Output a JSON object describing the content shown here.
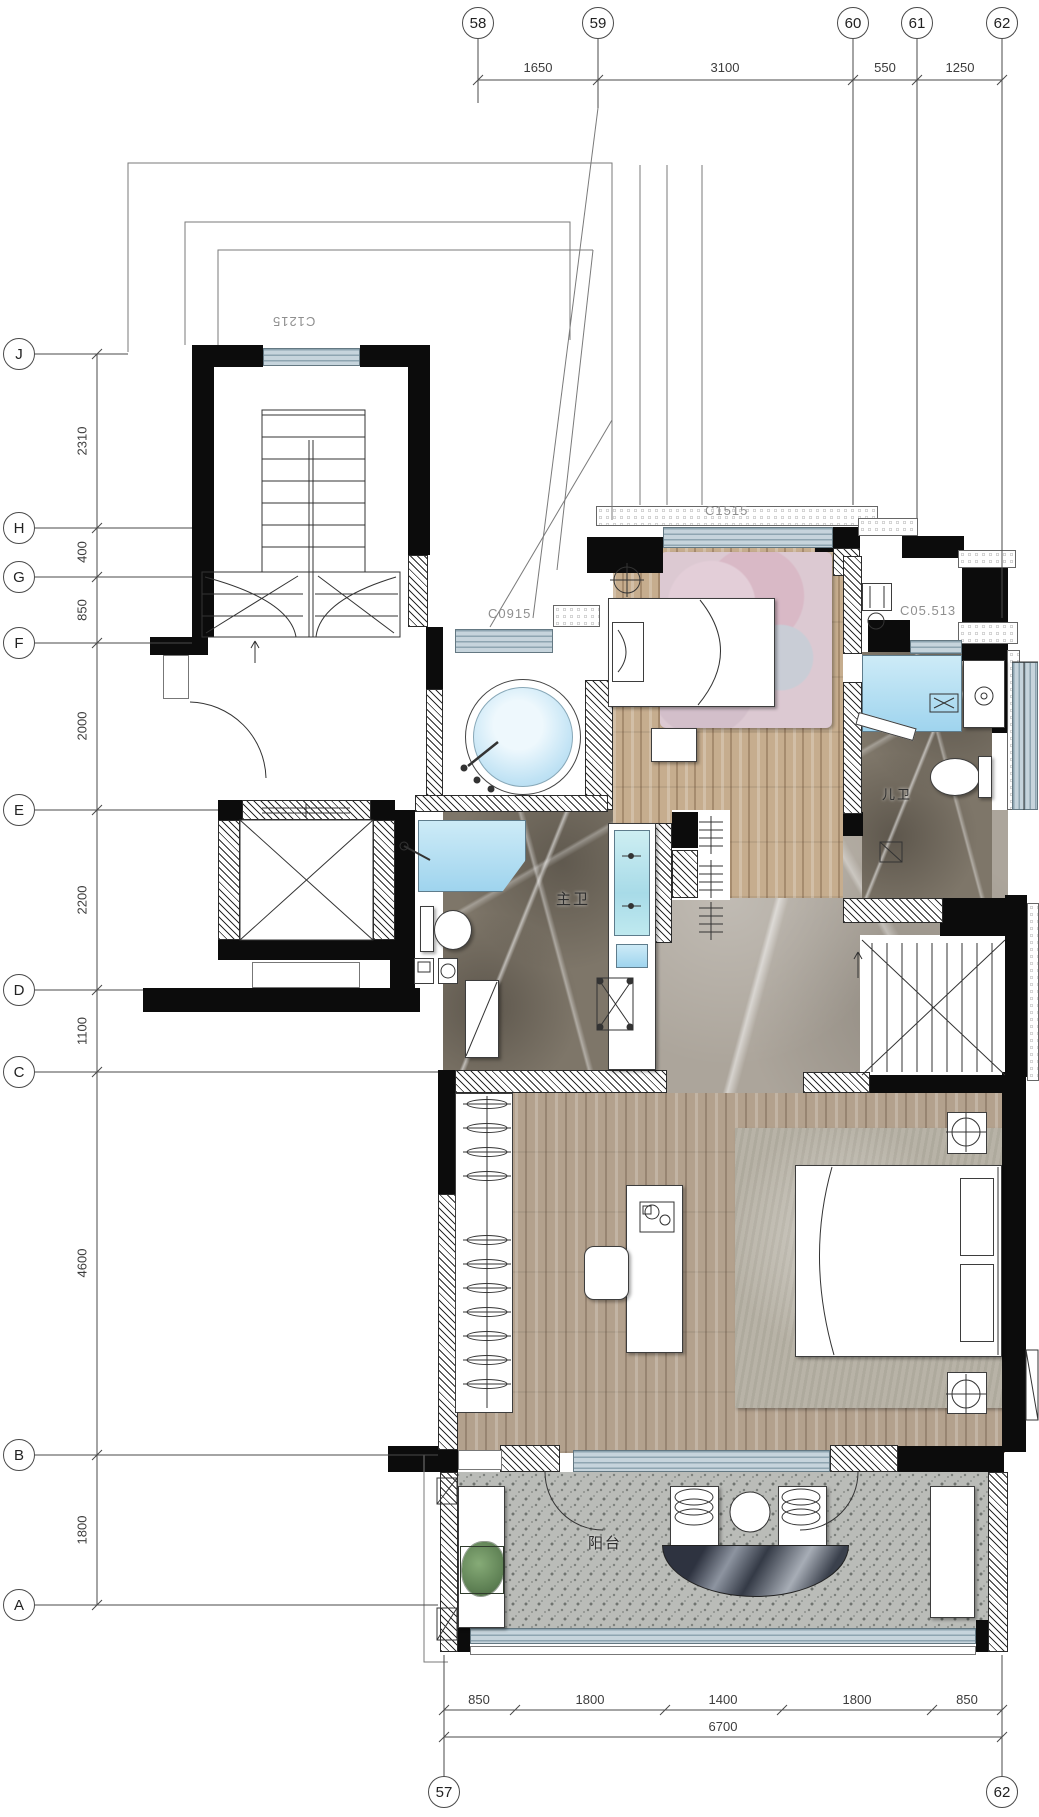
{
  "meta": {
    "drawing_type": "residential floor plan (upper level of duplex unit)"
  },
  "grid": {
    "top": {
      "bubbles": [
        "58",
        "59",
        "60",
        "61",
        "62"
      ],
      "dims": [
        "1650",
        "3100",
        "550",
        "1250"
      ]
    },
    "left": {
      "bubbles": [
        "J",
        "H",
        "G",
        "F",
        "E",
        "D",
        "C",
        "B",
        "A"
      ],
      "dims": [
        "2310",
        "400",
        "850",
        "2000",
        "2200",
        "1100",
        "4600",
        "1800"
      ]
    },
    "bottom": {
      "bubbles": [
        "57",
        "62"
      ],
      "dims": [
        "850",
        "1800",
        "1400",
        "1800",
        "850"
      ],
      "total": "6700"
    }
  },
  "windows": {
    "stairwell": "C1215",
    "kids_bedroom": "C1515",
    "tub_room": "C0915",
    "kids_bath": "C05.513"
  },
  "rooms": {
    "master_bath": "主卫",
    "kids_bath": "儿卫",
    "balcony": "阳台"
  },
  "colors": {
    "window_frame": "#b9c8d2",
    "glass_blue": "#aee0f4",
    "wood_light": "#c6ad8e",
    "wood_grey": "#b3a18d",
    "marble_dark": "#7e7669",
    "marble_light": "#aca59b",
    "terrazzo_grey": "#babcb8",
    "rug_pink": "#dcc9d2",
    "plant_green": "#6d9463",
    "wall_black": "#0c0c0c"
  }
}
